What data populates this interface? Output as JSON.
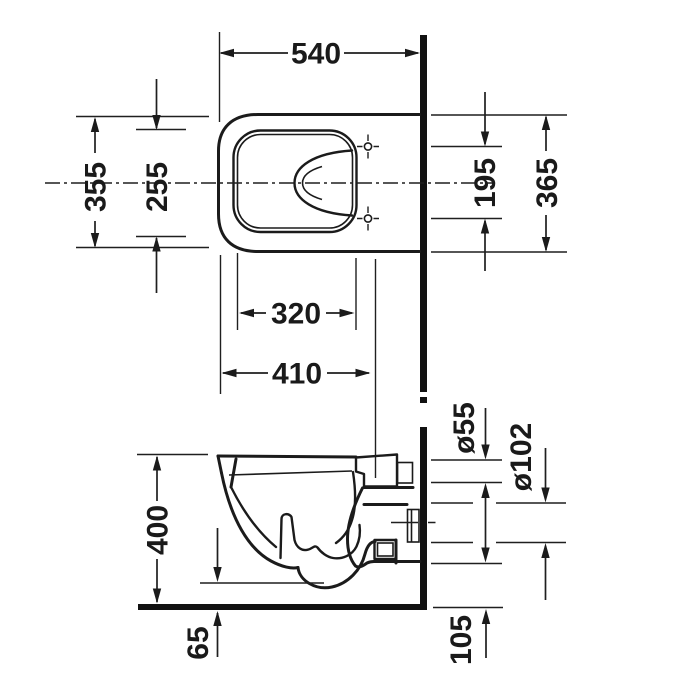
{
  "drawing": {
    "type": "technical-dimension-drawing",
    "subject": "wall-hung-toilet",
    "background_color": "#ffffff",
    "line_color": "#1b1b1b",
    "views": {
      "plan_view_name": "top view",
      "side_view_name": "side elevation"
    }
  },
  "dimensions": {
    "plan_view": {
      "overall_depth": "540",
      "overall_width": "355",
      "inner_bowl_width": "255",
      "fixing_hole_spacing": "195",
      "rear_width": "365",
      "inner_bowl_length": "320",
      "front_to_fixing": "410"
    },
    "side_view": {
      "rim_height": "400",
      "underside_clearance": "65",
      "flush_inlet_diameter": "ø55",
      "outlet_diameter": "ø102",
      "outlet_support_height": "105"
    }
  }
}
